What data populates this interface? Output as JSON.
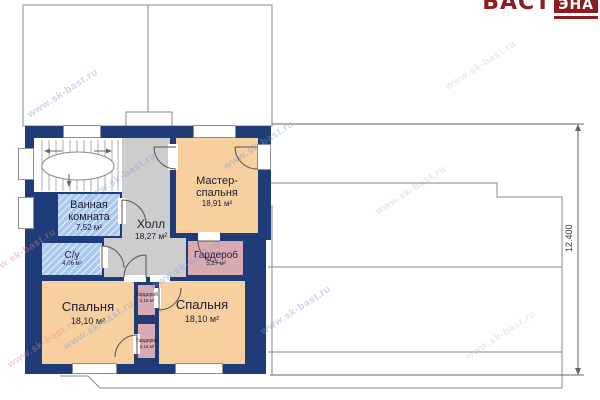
{
  "logo": {
    "text": "БАСТ",
    "boxed": "ЭНА"
  },
  "watermark": {
    "text": "www.sk-bast.ru"
  },
  "plan": {
    "rooms": {
      "master": {
        "name": "Мастер-спальня",
        "area": "18,91 м²"
      },
      "hall": {
        "name": "Холл",
        "area": "18,27 м²"
      },
      "bathroom": {
        "name": "Ванная комната",
        "area": "7,52 м²"
      },
      "wc": {
        "name": "С/у",
        "area": "4,06 м²"
      },
      "wardrobe": {
        "name": "Гардероб",
        "area": "5,27 м²"
      },
      "bedroom_left": {
        "name": "Спальня",
        "area": "18,10 м²"
      },
      "bedroom_right": {
        "name": "Спальня",
        "area": "18,10 м²"
      },
      "closet_top": {
        "name": "Гардероб",
        "area": "2,18 м²"
      },
      "closet_bottom": {
        "name": "Гардероб",
        "area": "2,18 м²"
      }
    },
    "dimensions": {
      "height_total": "12.400"
    }
  },
  "colors": {
    "wall": "#1e3c78",
    "room_peach": "#f8d09f",
    "room_gray": "#cdcdcd",
    "room_blue_hatch": "#a9c9ee",
    "room_mauve": "#d9aab2",
    "outline_gray": "#8a8a8a",
    "logo_red": "#8c1c1f"
  }
}
